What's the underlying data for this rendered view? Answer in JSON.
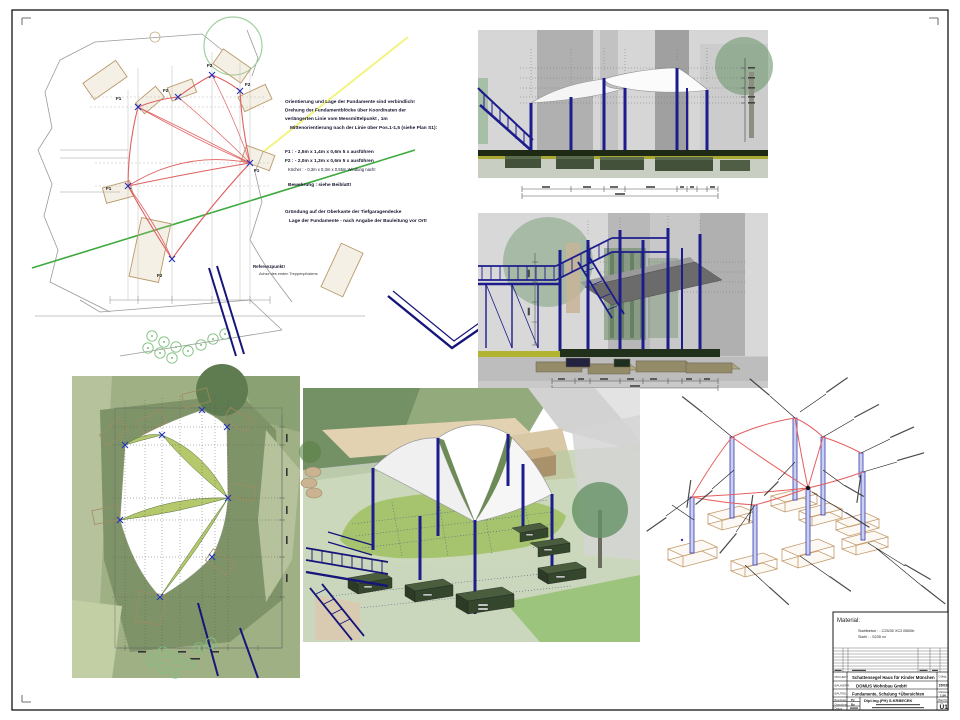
{
  "sheet": {
    "labels": {
      "f1": "F1",
      "f2": "F2"
    }
  },
  "plan": {
    "notes_orientation": [
      "Orientierung und Lage der Fundamente sind verbindlich!",
      "Drehung der Fundamentblöcke über Koordinaten der",
      "verlängerten Linie vom Messmittelpunkt , 1m",
      "Mittenorientierung nach der Linie über Pos.1-1,5 (siehe Plan S1):"
    ],
    "spec_f1": "F1 : - 2,5m x 1,4m x 0,6m  5 x ausführen",
    "spec_f2": "F2 : - 2,0m x 1,3m x 0,6m  5 x ausführen",
    "spec_koecher": "Köcher : - 0,3m x 0,3m x 0,55m  Windung nach!",
    "spec_bewehrung": "Bewehrung : siehe Beiblatt!",
    "notes_gruendung": [
      "Gründung auf der Oberkante der Tiefgaragendecke",
      "Lage der Fundamente - nach Angabe der Bauleitung vor Ort!"
    ],
    "reference": {
      "title": "Referenzpunkt!",
      "subtitle": "Achse des ersten Treppenpfostens"
    }
  },
  "title_block": {
    "material_title": "Material:",
    "material_lines": [
      "Stahlbeton : - C25/30 XC2 B500b",
      "Stahl          : - S235 xx"
    ],
    "project_label": "PROJEKT",
    "project": "Schattensegel  Haus für Kinder München",
    "client_label": "BAUHERR",
    "client": "DOMUS Wohnbau GmbH",
    "part_label": "BAUTEIL",
    "part": "Fundamente, Schalung +Übersichten",
    "valid_label": "Gültig",
    "project_no": "15/038",
    "scale_label": "Maßstab",
    "scale": "1:50",
    "drawn_label": "Bearbeitet",
    "drawn_by": "Py",
    "traced_label": "Gezeichnet",
    "traced_by": "By",
    "date_label": "Datum",
    "engineer": "Dipl.Ing.(FH)  S.KRBECEK",
    "sheet_label": "Blatt Nr",
    "sheet_no": "Ü1"
  },
  "colors": {
    "navy": "#1c1c8c",
    "red_sail": "#e06060",
    "green_line": "#3caa3c",
    "tan": "#b89968",
    "olive": "#a8a832"
  }
}
